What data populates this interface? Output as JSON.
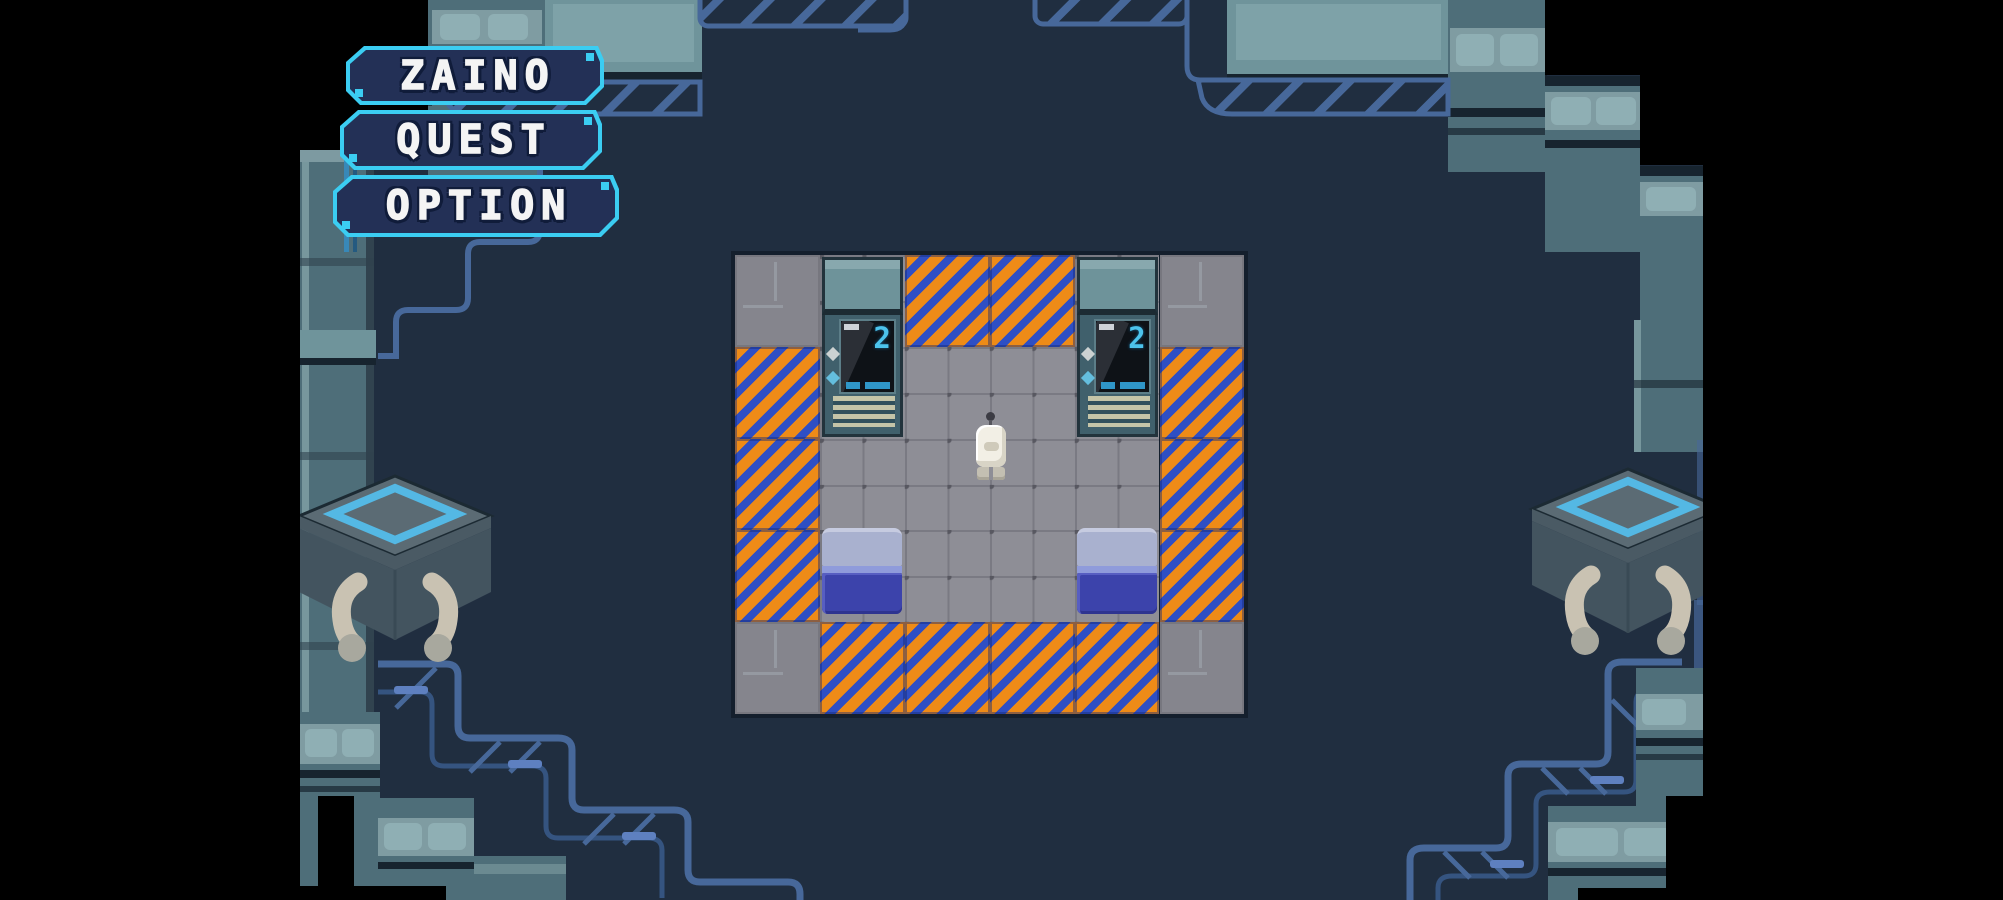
{
  "scene": {
    "bars_color": "#000000",
    "field_color": "#202e40",
    "accent_cyan": "#3bcdf2",
    "structure_teal": "#4e6e79",
    "hazard_orange": "#ee8b17",
    "hazard_blue": "#2e4fc4",
    "floor_gray": "#8e8e96",
    "bed_pillow": "#a9b1cf",
    "bed_blanket": "#3c43ab"
  },
  "menu": {
    "buttons": [
      {
        "id": "zaino",
        "label": "ZAINO"
      },
      {
        "id": "quest",
        "label": "QUEST"
      },
      {
        "id": "option",
        "label": "OPTION"
      }
    ]
  },
  "room": {
    "cols": 6,
    "rows": 5,
    "tilemap": [
      [
        "panel",
        "floor",
        "hazard",
        "hazard",
        "floor",
        "panel"
      ],
      [
        "hazard",
        "floor",
        "floor",
        "floor",
        "floor",
        "hazard"
      ],
      [
        "hazard",
        "floor",
        "floor",
        "floor",
        "floor",
        "hazard"
      ],
      [
        "hazard",
        "floor",
        "floor",
        "floor",
        "floor",
        "hazard"
      ],
      [
        "panel",
        "hazard",
        "hazard",
        "hazard",
        "hazard",
        "panel"
      ]
    ],
    "objects": [
      {
        "type": "console",
        "col": 1,
        "row": 0
      },
      {
        "type": "console",
        "col": 4,
        "row": 0
      },
      {
        "type": "bed",
        "col": 1,
        "row": 3
      },
      {
        "type": "bed",
        "col": 4,
        "row": 3
      },
      {
        "type": "player",
        "col": 3,
        "row": 2
      }
    ],
    "console_screen_digit": "2"
  }
}
